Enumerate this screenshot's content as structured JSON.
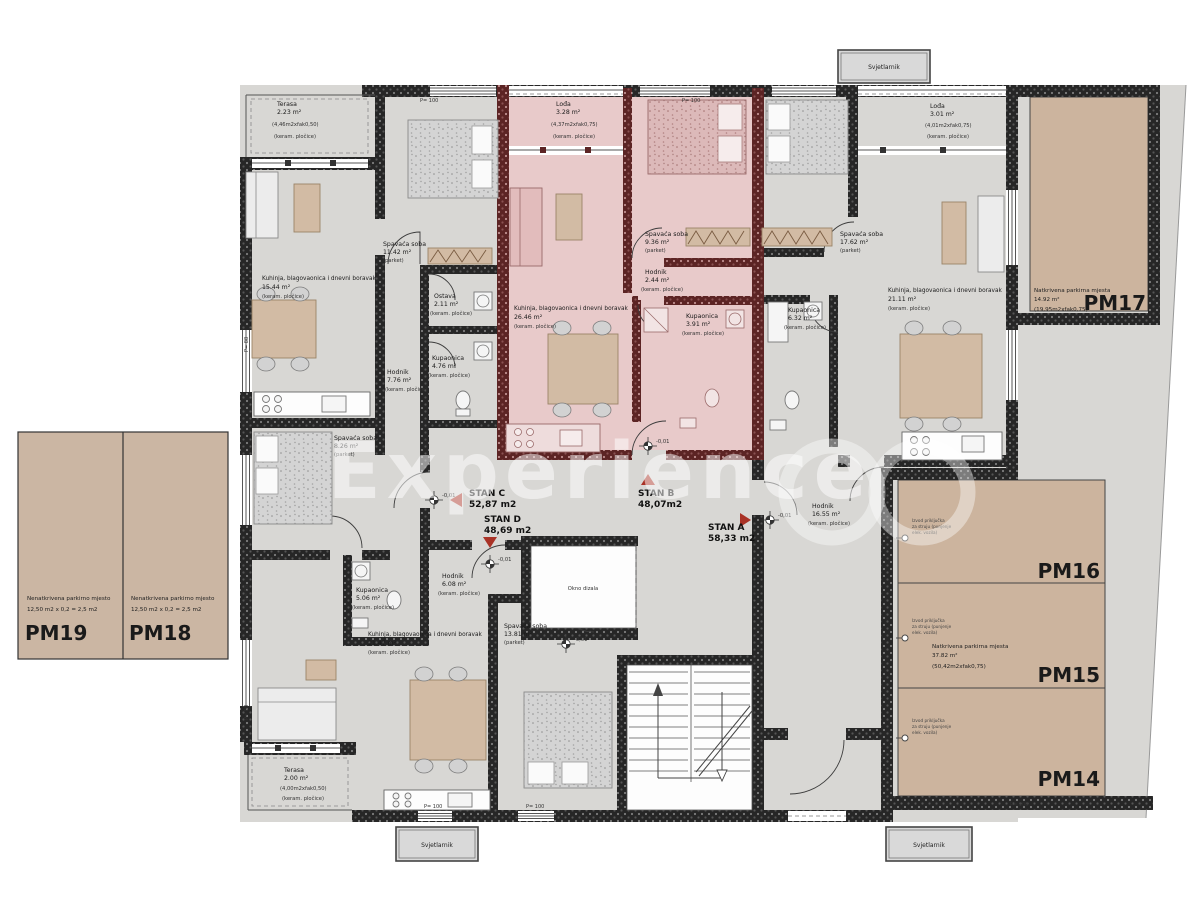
{
  "watermark": "Experience",
  "labels": {
    "kitchen_living": "Kuhinja, blagovaonica i dnevni boravak",
    "bedroom": "Spavaća soba",
    "bathroom": "Kupaonica",
    "hallway": "Hodnik",
    "terrace": "Terasa",
    "loggia": "Lođa",
    "storage": "Ostava"
  },
  "flooring": {
    "ceramic": "(keram. pločice)",
    "parquet": "(parket)"
  },
  "marks": {
    "parapet100": "P= 100",
    "parapet88": "P= 88",
    "level": "-0,01",
    "skylight": "Svjetlarnik",
    "elevator": "Okno dizala"
  },
  "apartments": {
    "a": {
      "name": "STAN A",
      "area": "58,33 m2"
    },
    "b": {
      "name": "STAN B",
      "area": "48,07m2"
    },
    "c": {
      "name": "STAN C",
      "area": "52,87 m2"
    },
    "d": {
      "name": "STAN D",
      "area": "48,69 m2"
    }
  },
  "rooms": {
    "terasa_c": {
      "area": "2.23 m²",
      "calc": "(4,46m2xfak0,50)"
    },
    "bedroom_c1": {
      "area": "11.42 m²"
    },
    "ostava_c": {
      "area": "2.11 m²"
    },
    "living_c": {
      "area": "15.44 m²"
    },
    "hodnik_c": {
      "area": "7.76 m²"
    },
    "kupaonica_c": {
      "area": "4.76 m²"
    },
    "bedroom_c2": {
      "area": "8.26 m²"
    },
    "lodja_b": {
      "area": "3.28 m²",
      "calc": "(4,37m2xfak0,75)"
    },
    "bedroom_b": {
      "area": "9.36 m²"
    },
    "hodnik_b": {
      "area": "2.44 m²"
    },
    "kupaonica_b": {
      "area": "3.91 m²"
    },
    "living_b": {
      "area": "26.46 m²"
    },
    "bedroom_a": {
      "area": "17.62 m²"
    },
    "kupaonica_a": {
      "area": "6.32 m²"
    },
    "lodja_a": {
      "area": "3.01 m²",
      "calc": "(4,01m2xfak0,75)"
    },
    "living_a": {
      "area": "21.11 m²"
    },
    "hodnik_a": {
      "area": "16.55 m²"
    },
    "kupaonica_d": {
      "area": "5.06 m²"
    },
    "hodnik_d": {
      "area": "6.08 m²"
    },
    "living_d": {
      "area": "21.47 m²"
    },
    "bedroom_d": {
      "area": "13.81 m²"
    },
    "terasa_d": {
      "area": "2.00 m²",
      "calc": "(4,00m2xfak0,50)"
    }
  },
  "parking": {
    "covered_desc": "Natkrivena parkirna mjesta",
    "uncovered_desc": "Nenatkrivena parkirno mjesto",
    "uncovered_calc": "12,50 m2 x 0,2 = 2,5 m2",
    "pm14": "PM14",
    "pm15": "PM15",
    "pm16": "PM16",
    "pm17": "PM17",
    "pm18": "PM18",
    "pm19": "PM19",
    "pm17_area": "14.92 m²",
    "pm17_calc": "(19,95m2xfak0,75)",
    "pm15_area": "37.82 m²",
    "pm15_calc": "(50,42m2xfak0,75)",
    "ev": {
      "l1": "Izvod priključka",
      "l2": "za struju (punjenje",
      "l3": "elek. vozila)"
    }
  },
  "colors": {
    "highlight_apartment": "#e8caca",
    "wall": "#262626",
    "pink_wall": "#5c2424",
    "parking": "#ccb49e",
    "entry_marker_red": "#a93226",
    "plan_gray": "#d8d7d4"
  }
}
